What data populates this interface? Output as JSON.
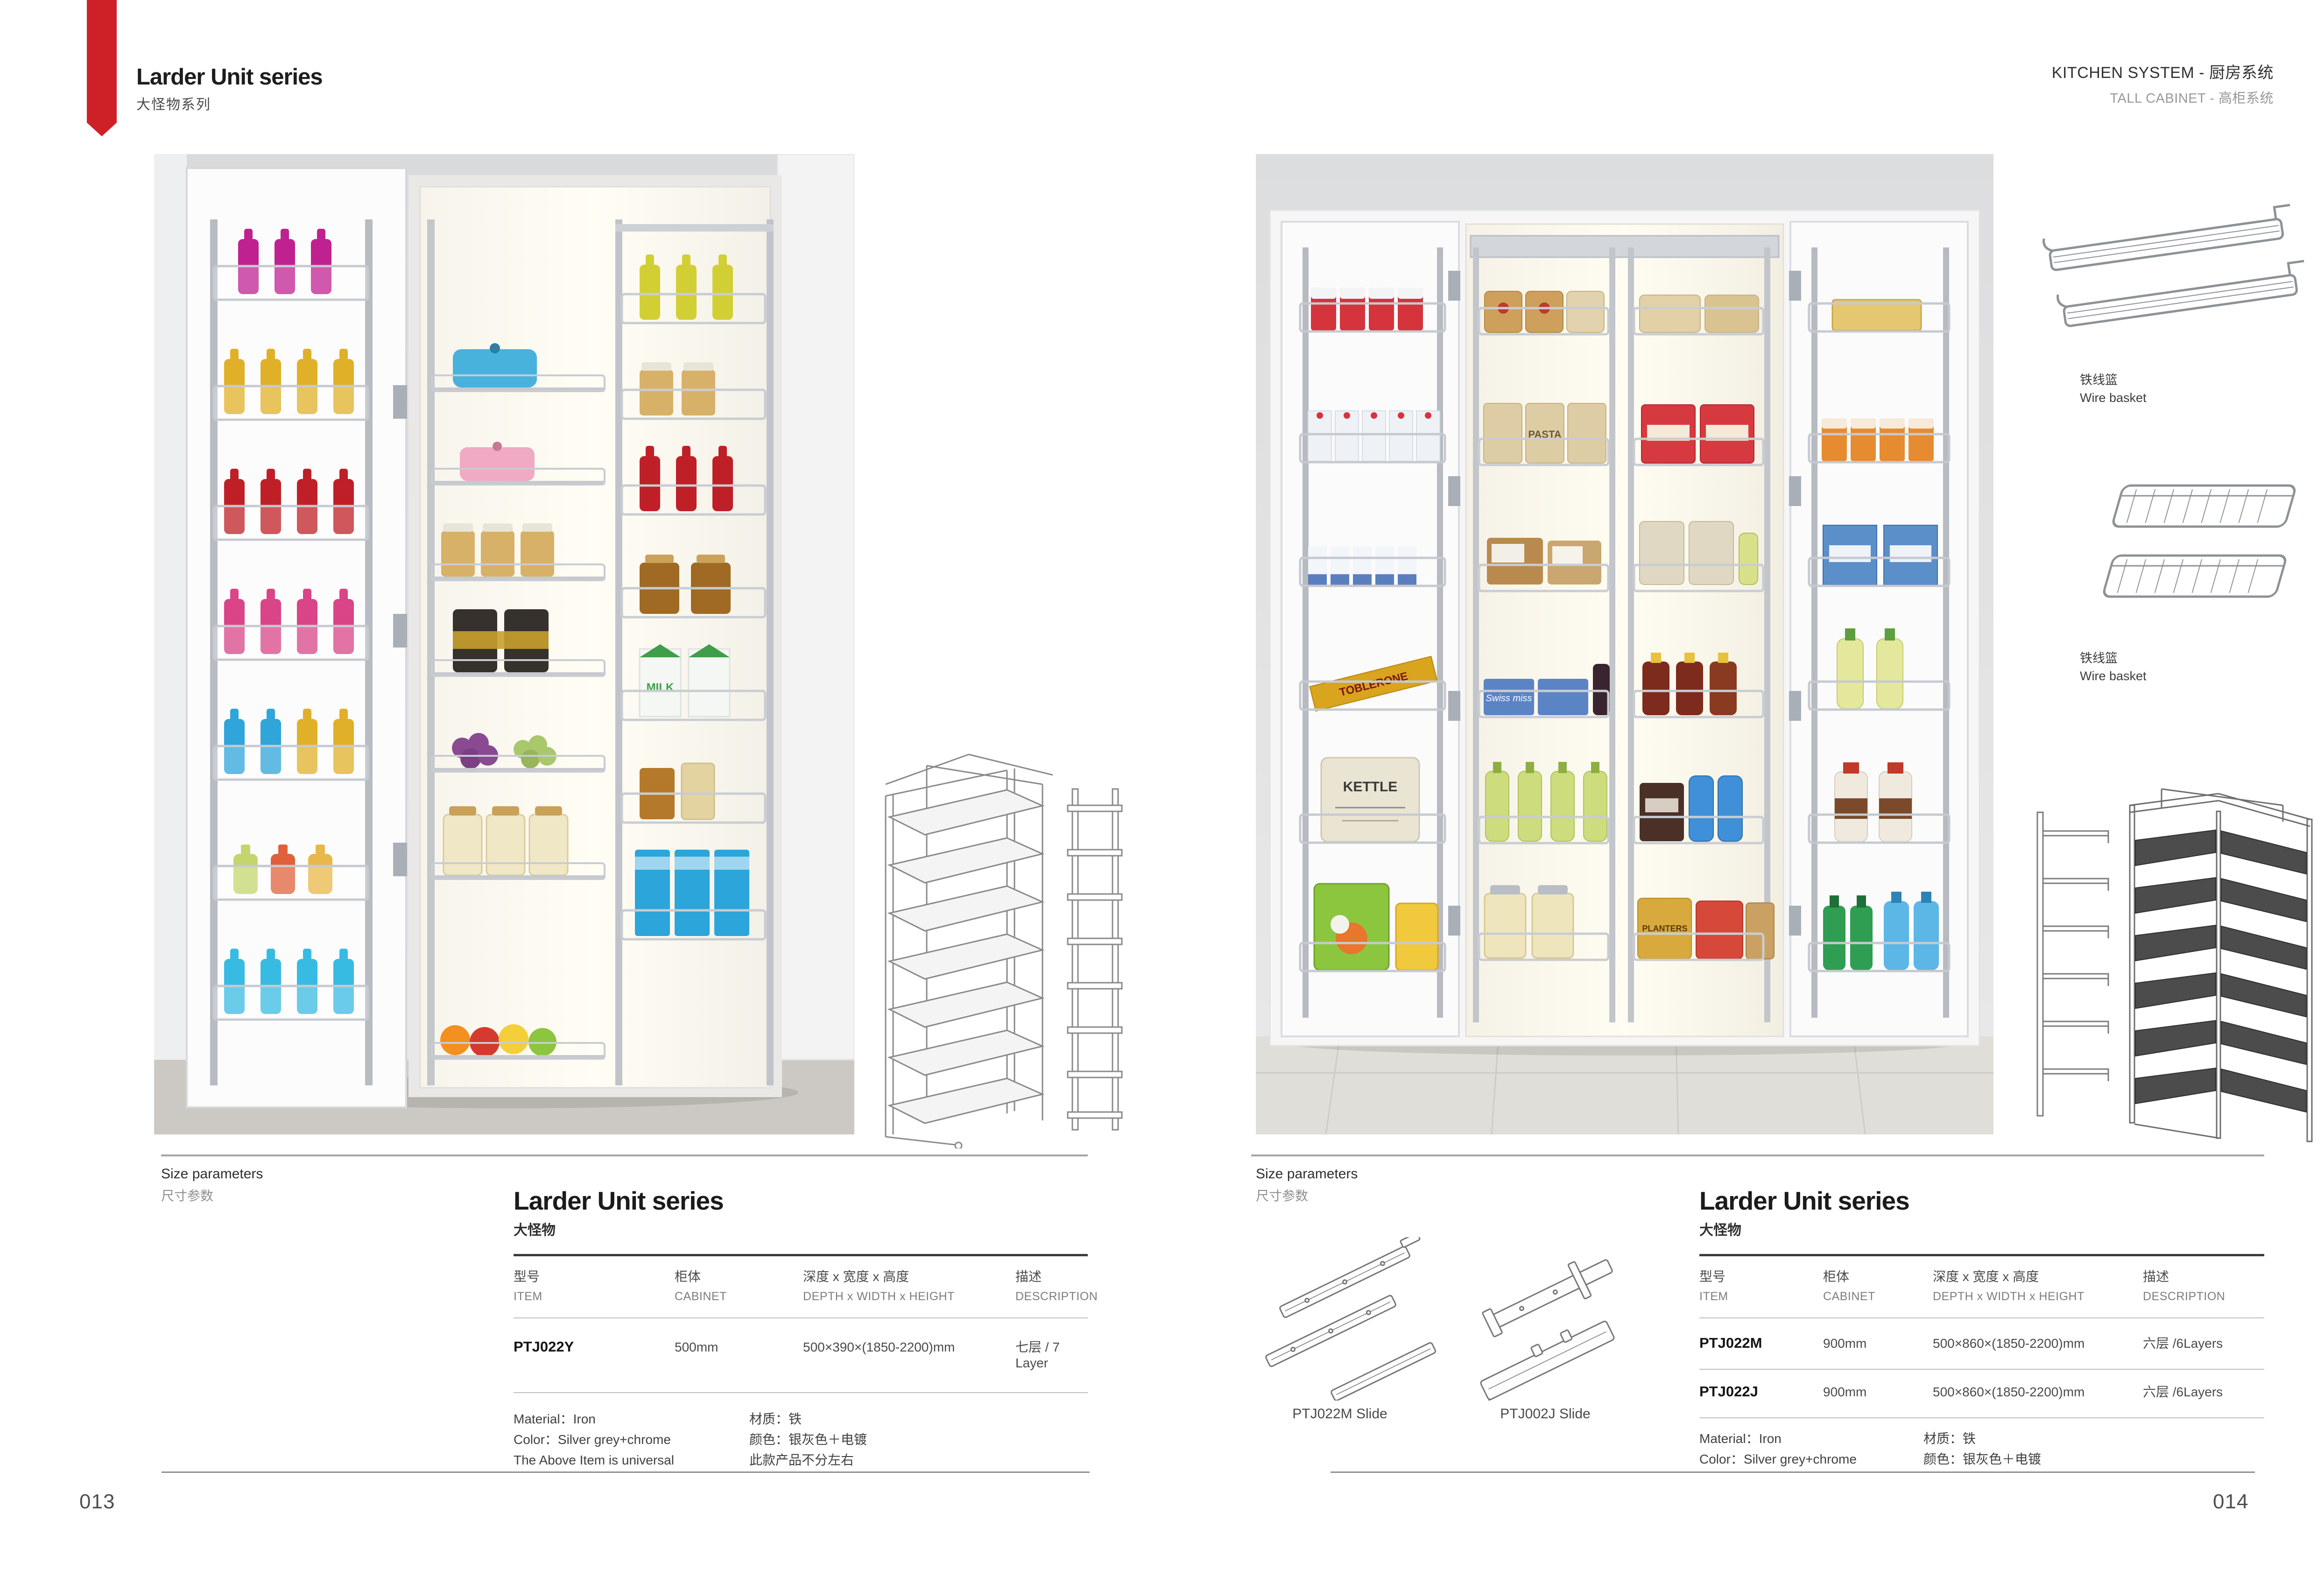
{
  "colors": {
    "accent_red": "#ce2127",
    "silver_rail": "#b8bcc2",
    "table_rule_dark": "#3c3c3c",
    "table_rule_light": "#c0c0c0"
  },
  "left_page": {
    "page_number": "013",
    "series_title": "Larder Unit series",
    "series_title_cn": "大怪物系列",
    "size_parameters": "Size parameters",
    "size_parameters_cn": "尺寸参数",
    "table": {
      "title": "Larder Unit series",
      "title_cn": "大怪物",
      "col_item_cn": "型号",
      "col_item_en": "ITEM",
      "col_cabinet_cn": "柜体",
      "col_cabinet_en": "CABINET",
      "col_dim_cn": "深度 x 宽度 x 高度",
      "col_dim_en": "DEPTH x WIDTH x HEIGHT",
      "col_desc_cn": "描述",
      "col_desc_en": "DESCRIPTION",
      "rows": [
        {
          "item": "PTJ022Y",
          "cabinet": "500mm",
          "dimensions": "500×390×(1850-2200)mm",
          "description": "七层 / 7 Layer"
        }
      ],
      "note_material_en": "Material：Iron",
      "note_material_cn": "材质：铁",
      "note_color_en": "Color：Silver grey+chrome",
      "note_color_cn": "颜色：银灰色＋电镀",
      "note_universal_en": "The Above Item is universal",
      "note_universal_cn": "此款产品不分左右"
    },
    "photo_labels": {
      "milk": "MILK"
    }
  },
  "right_page": {
    "page_number": "014",
    "header_line1": "KITCHEN SYSTEM - 厨房系统",
    "header_line2": "TALL CABINET - 高柜系统",
    "size_parameters": "Size parameters",
    "size_parameters_cn": "尺寸参数",
    "wire_basket_1_cn": "铁线篮",
    "wire_basket_1_en": "Wire basket",
    "wire_basket_2_cn": "铁线篮",
    "wire_basket_2_en": "Wire basket",
    "slide_m_label": "PTJ022M Slide",
    "slide_j_label": "PTJ002J Slide",
    "table": {
      "title": "Larder Unit series",
      "title_cn": "大怪物",
      "col_item_cn": "型号",
      "col_item_en": "ITEM",
      "col_cabinet_cn": "柜体",
      "col_cabinet_en": "CABINET",
      "col_dim_cn": "深度 x 宽度 x 高度",
      "col_dim_en": "DEPTH x WIDTH x HEIGHT",
      "col_desc_cn": "描述",
      "col_desc_en": "DESCRIPTION",
      "rows": [
        {
          "item": "PTJ022M",
          "cabinet": "900mm",
          "dimensions": "500×860×(1850-2200)mm",
          "description": "六层 /6Layers"
        },
        {
          "item": "PTJ022J",
          "cabinet": "900mm",
          "dimensions": "500×860×(1850-2200)mm",
          "description": "六层 /6Layers"
        }
      ],
      "note_material_en": "Material：Iron",
      "note_material_cn": "材质：铁",
      "note_color_en": "Color：Silver grey+chrome",
      "note_color_cn": "颜色：银灰色＋电镀"
    },
    "photo_labels": {
      "toblerone": "TOBLERONE",
      "kettle": "KETTLE",
      "planters": "PLANTERS",
      "swiss": "Swiss miss",
      "pasta": "PASTA"
    }
  }
}
